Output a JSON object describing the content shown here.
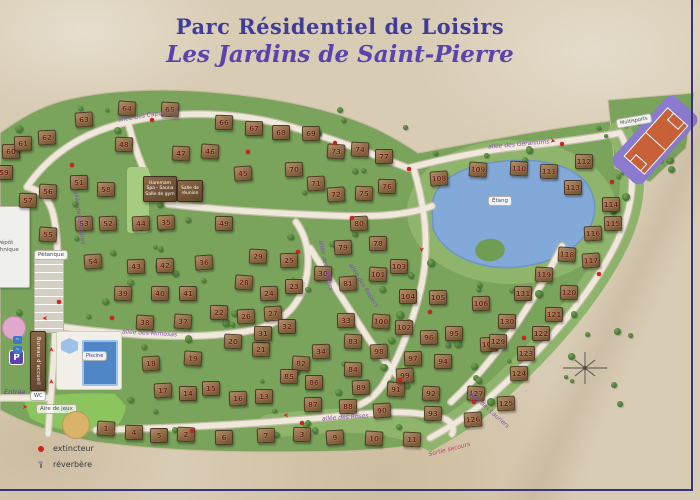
{
  "title": {
    "line1": "Parc Résidentiel de Loisirs",
    "line2": "Les Jardins de Saint-Pierre"
  },
  "legend": {
    "items": [
      {
        "label": "extincteur"
      },
      {
        "label": "réverbère"
      }
    ]
  },
  "facilities": {
    "petanque": "Pétanque",
    "spa_line1": "Hammam",
    "spa_line2": "Spa - Sauna",
    "spa_line3": "Salle de gym",
    "meeting": "Salle de réunion",
    "pool": "Piscine",
    "playground": "Aire de jeux",
    "reception": "Bureau d'accueil",
    "wc": "WC",
    "parking": "P",
    "entrance": "Entrée",
    "depot_line1": "Dépôt",
    "depot_line2": "technique",
    "multisports": "Multisports",
    "lake": "Étang",
    "emergency": "Sortie secours"
  },
  "colors": {
    "parchment": "#d9ccb4",
    "green": "#7aa45c",
    "green_light": "#8fb56d",
    "lake": "#83a9d8",
    "road": "#efe9db",
    "title_purple": "#5b43ad",
    "field_purple": "#8a7ad0",
    "field_orange": "#c86038",
    "status_red": "#d02020"
  },
  "streets": [
    {
      "name": "allée des Capucines",
      "x": 118,
      "y": 112,
      "rot": -9
    },
    {
      "name": "allée des Géraniums",
      "x": 488,
      "y": 141,
      "rot": -5
    },
    {
      "name": "allée des Roses",
      "x": 322,
      "y": 414,
      "rot": -4
    },
    {
      "name": "allée des Lauriers",
      "x": 462,
      "y": 406,
      "rot": 42
    },
    {
      "name": "allée des Mimosas",
      "x": 122,
      "y": 330,
      "rot": 3
    },
    {
      "name": "allée des Rosiers",
      "x": 338,
      "y": 282,
      "rot": 58
    },
    {
      "name": "allée des Mûriers",
      "x": 300,
      "y": 262,
      "rot": 78
    },
    {
      "name": "allée des Glycines",
      "x": 52,
      "y": 214,
      "rot": 82
    }
  ],
  "houses": [
    [
      1,
      105,
      427
    ],
    [
      2,
      185,
      433
    ],
    [
      3,
      301,
      433
    ],
    [
      4,
      133,
      431
    ],
    [
      5,
      158,
      434
    ],
    [
      6,
      223,
      436
    ],
    [
      7,
      265,
      434
    ],
    [
      9,
      334,
      436
    ],
    [
      10,
      373,
      437
    ],
    [
      11,
      411,
      438
    ],
    [
      13,
      263,
      395
    ],
    [
      14,
      187,
      392
    ],
    [
      15,
      210,
      387
    ],
    [
      16,
      237,
      397
    ],
    [
      17,
      162,
      389
    ],
    [
      18,
      150,
      362
    ],
    [
      19,
      192,
      357
    ],
    [
      20,
      232,
      340
    ],
    [
      21,
      260,
      348
    ],
    [
      22,
      218,
      311
    ],
    [
      23,
      293,
      285
    ],
    [
      24,
      268,
      292
    ],
    [
      25,
      288,
      259
    ],
    [
      26,
      245,
      315
    ],
    [
      27,
      272,
      312
    ],
    [
      28,
      243,
      281
    ],
    [
      29,
      257,
      255
    ],
    [
      30,
      322,
      272
    ],
    [
      31,
      262,
      332
    ],
    [
      32,
      286,
      325
    ],
    [
      33,
      345,
      319
    ],
    [
      34,
      320,
      350
    ],
    [
      35,
      165,
      221
    ],
    [
      36,
      203,
      261
    ],
    [
      37,
      182,
      320
    ],
    [
      38,
      144,
      321
    ],
    [
      39,
      122,
      292
    ],
    [
      40,
      159,
      292
    ],
    [
      41,
      187,
      292
    ],
    [
      42,
      164,
      264
    ],
    [
      43,
      135,
      265
    ],
    [
      44,
      140,
      222
    ],
    [
      45,
      242,
      172
    ],
    [
      46,
      209,
      150
    ],
    [
      47,
      180,
      152
    ],
    [
      48,
      123,
      143
    ],
    [
      49,
      223,
      222
    ],
    [
      51,
      78,
      181
    ],
    [
      52,
      107,
      222
    ],
    [
      53,
      83,
      222
    ],
    [
      54,
      92,
      260
    ],
    [
      55,
      47,
      233
    ],
    [
      56,
      47,
      190
    ],
    [
      57,
      27,
      199
    ],
    [
      58,
      105,
      188
    ],
    [
      59,
      3,
      171
    ],
    [
      60,
      10,
      150
    ],
    [
      61,
      22,
      142
    ],
    [
      62,
      46,
      136
    ],
    [
      63,
      83,
      118
    ],
    [
      64,
      126,
      107
    ],
    [
      65,
      169,
      108
    ],
    [
      66,
      223,
      121
    ],
    [
      67,
      253,
      127
    ],
    [
      68,
      280,
      131
    ],
    [
      69,
      310,
      132
    ],
    [
      70,
      293,
      168
    ],
    [
      71,
      315,
      182
    ],
    [
      72,
      335,
      193
    ],
    [
      73,
      335,
      150
    ],
    [
      74,
      359,
      148
    ],
    [
      75,
      363,
      192
    ],
    [
      76,
      386,
      185
    ],
    [
      77,
      383,
      155
    ],
    [
      78,
      377,
      242
    ],
    [
      79,
      342,
      246
    ],
    [
      80,
      358,
      222
    ],
    [
      81,
      347,
      282
    ],
    [
      82,
      300,
      362
    ],
    [
      83,
      352,
      340
    ],
    [
      84,
      352,
      368
    ],
    [
      85,
      288,
      375
    ],
    [
      86,
      313,
      381
    ],
    [
      87,
      312,
      403
    ],
    [
      88,
      347,
      405
    ],
    [
      89,
      360,
      386
    ],
    [
      90,
      381,
      409
    ],
    [
      91,
      395,
      388
    ],
    [
      92,
      430,
      392
    ],
    [
      93,
      432,
      412
    ],
    [
      94,
      442,
      360
    ],
    [
      95,
      453,
      332
    ],
    [
      96,
      428,
      336
    ],
    [
      97,
      412,
      357
    ],
    [
      98,
      378,
      350
    ],
    [
      99,
      404,
      374
    ],
    [
      100,
      380,
      320
    ],
    [
      101,
      377,
      273
    ],
    [
      102,
      403,
      326
    ],
    [
      103,
      398,
      265
    ],
    [
      104,
      407,
      295
    ],
    [
      105,
      437,
      296
    ],
    [
      106,
      480,
      302
    ],
    [
      107,
      488,
      343
    ],
    [
      108,
      438,
      177
    ],
    [
      109,
      477,
      168
    ],
    [
      110,
      518,
      167
    ],
    [
      111,
      548,
      170
    ],
    [
      112,
      583,
      160
    ],
    [
      113,
      572,
      186
    ],
    [
      114,
      610,
      203
    ],
    [
      115,
      612,
      222
    ],
    [
      116,
      592,
      232
    ],
    [
      117,
      590,
      259
    ],
    [
      118,
      566,
      253
    ],
    [
      119,
      543,
      273
    ],
    [
      120,
      568,
      291
    ],
    [
      121,
      553,
      313
    ],
    [
      122,
      540,
      332
    ],
    [
      123,
      525,
      352
    ],
    [
      124,
      518,
      372
    ],
    [
      125,
      505,
      402
    ],
    [
      126,
      472,
      418
    ],
    [
      127,
      475,
      392
    ],
    [
      129,
      497,
      340
    ],
    [
      130,
      506,
      320
    ],
    [
      131,
      522,
      292
    ]
  ],
  "markers": {
    "extincteurs": [
      [
        70,
        163
      ],
      [
        150,
        118
      ],
      [
        246,
        150
      ],
      [
        333,
        141
      ],
      [
        407,
        167
      ],
      [
        560,
        142
      ],
      [
        610,
        180
      ],
      [
        597,
        272
      ],
      [
        522,
        336
      ],
      [
        472,
        400
      ],
      [
        398,
        378
      ],
      [
        300,
        421
      ],
      [
        190,
        429
      ],
      [
        57,
        300
      ],
      [
        110,
        316
      ],
      [
        428,
        310
      ],
      [
        350,
        216
      ],
      [
        296,
        250
      ]
    ],
    "arrows": [
      {
        "x": 42,
        "y": 314,
        "rot": 180
      },
      {
        "x": 49,
        "y": 346,
        "rot": -90
      },
      {
        "x": 49,
        "y": 378,
        "rot": -90
      },
      {
        "x": 283,
        "y": 411,
        "rot": 180
      },
      {
        "x": 550,
        "y": 138,
        "rot": 10
      },
      {
        "x": 418,
        "y": 246,
        "rot": 95
      },
      {
        "x": 22,
        "y": 404,
        "rot": 0
      }
    ]
  }
}
